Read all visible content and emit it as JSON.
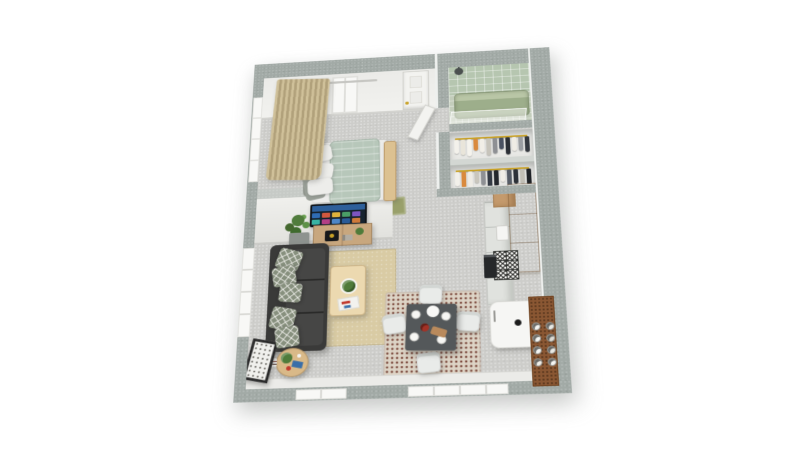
{
  "scene": {
    "description": "3D top-down dollhouse render of a studio apartment floor plan",
    "rooms": [
      "sleeping area",
      "entry hall",
      "bathroom",
      "closet",
      "kitchen",
      "living area",
      "dining area"
    ]
  },
  "colors": {
    "wallCap": "#a2aaa6",
    "wallFace": "#ebebe8",
    "floor": "#cdcdca",
    "window": "#f8f8f6",
    "door": "#f3f3f0",
    "brass": "#c9a227",
    "curtain1": "#cfc099",
    "curtain2": "#b1a17b",
    "duvet": "#b7c7ba",
    "sheet": "#ececea",
    "pillowDark": "#8f948c",
    "benchWood": "#dcc191",
    "lampBlack": "#171717",
    "lampGold": "#c9a43c",
    "tvBezel": "#101418",
    "consoleWood": "#c8a77e",
    "plantGreen": "#4f7b3a",
    "planter": "#8e938f",
    "sofa": "#3a3a39",
    "sofaSeat": "#464645",
    "pillowPattern": "#87907e",
    "rugBeige": "#d9cba4",
    "coffeeWood": "#ecd9b0",
    "sideWood": "#d9b988",
    "frame": "#2b2b2b",
    "diningTable": "#54585a",
    "chair": "#e9ebe9",
    "rugDining": "#ddd4c6",
    "rugDot": "#7c4a3d",
    "kitchenWood": "#c49a6c",
    "kitchenWoodDark": "#a87f52",
    "cabinet": "#e0e2de",
    "fridge": "#f6f6f4",
    "barWood": "#8a5733",
    "oven": "#26282a",
    "bathTile": "#b6c6b0",
    "bathFloor": "#c3cdbb",
    "tub": "#9dae8b",
    "tubRim": "#b9c6a6",
    "mat": "#99a06b"
  },
  "items": {
    "bed": "Double bed with sage duvet",
    "sofa": "Charcoal sofa",
    "tv": "Wall-mounted TV",
    "fridge": "Refrigerator",
    "tub": "Bathtub",
    "closet": "Open closet with hanging clothes",
    "dining": "Dining table for four",
    "coffee": "Coffee table",
    "curtains": "Curtains",
    "frame": "Leaning picture frame"
  },
  "closet": {
    "upper_clothes": [
      "#f3f1eb",
      "#e9e5da",
      "#f5f3ed",
      "#d98a3e",
      "#f1eee7",
      "#c7c4bb",
      "#8e9094",
      "#4a5262",
      "#2b2f36",
      "#efece5",
      "#9a9da1",
      "#33373e"
    ],
    "lower_clothes": [
      "#f2f0ea",
      "#d98a3e",
      "#efece5",
      "#c9c6bd",
      "#8e9094",
      "#343a44",
      "#23262c",
      "#f0ede6",
      "#565c66",
      "#2d3138",
      "#c2bfb6",
      "#1f2227"
    ]
  },
  "tv": {
    "tiles": [
      "#2f6cb3",
      "#d1583f",
      "#e0b23c",
      "#4a9e66",
      "#7d55c0",
      "#38b3a4",
      "#b23f85",
      "#4d86c8",
      "#2a5b97",
      "#cf7a3a"
    ]
  },
  "kitchen": {
    "bottles": [
      "#f5f5f2",
      "#e9e9e4",
      "#f5f5f2",
      "#dddad2",
      "#f5f5f2",
      "#e9e9e4",
      "#f2f0ea",
      "#f5f5f2"
    ],
    "backsplash_tiles": [
      "#f7f7f4",
      "#f7f7f4",
      "#f7f7f4",
      "#f7f7f4",
      "#f7f7f4",
      "#f7f7f4"
    ]
  }
}
